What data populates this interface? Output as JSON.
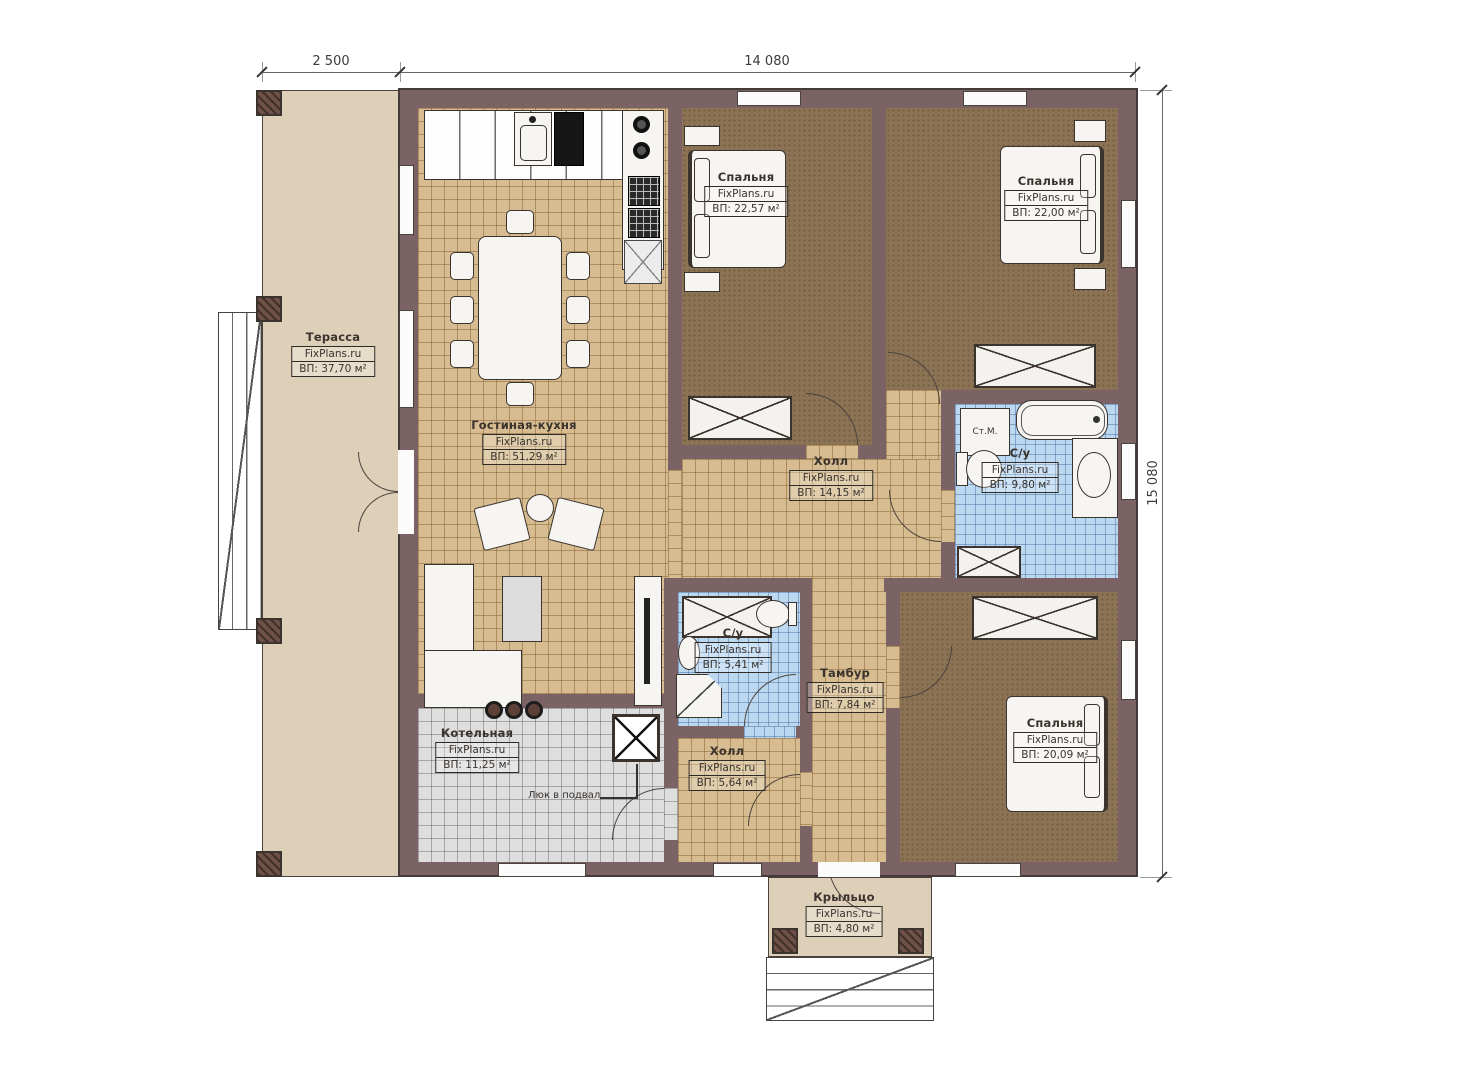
{
  "dimensions": {
    "terrace_width": "2 500",
    "house_width": "14 080",
    "house_height": "15 080"
  },
  "watermark": "FixPlans.ru",
  "rooms": {
    "terrace": {
      "name": "Терасса",
      "area": "ВП: 37,70 м²"
    },
    "living": {
      "name": "Гостиная-кухня",
      "area": "ВП: 51,29 м²"
    },
    "bedroom_top_left": {
      "name": "Спальня",
      "area": "ВП: 22,57 м²"
    },
    "bedroom_top_right": {
      "name": "Спальня",
      "area": "ВП: 22,00 м²"
    },
    "hall_main": {
      "name": "Холл",
      "area": "ВП: 14,15 м²"
    },
    "bathroom_main": {
      "name": "С/у",
      "area": "ВП: 9,80 м²"
    },
    "bathroom_small": {
      "name": "С/у",
      "area": "ВП: 5,41 м²"
    },
    "vestibule": {
      "name": "Тамбур",
      "area": "ВП: 7,84 м²"
    },
    "hall_small": {
      "name": "Холл",
      "area": "ВП: 5,64 м²"
    },
    "boiler": {
      "name": "Котельная",
      "area": "ВП: 11,25 м²"
    },
    "bedroom_bottom": {
      "name": "Спальня",
      "area": "ВП: 20,09 м²"
    },
    "porch": {
      "name": "Крыльцо",
      "area": "ВП: 4,80 м²"
    }
  },
  "annotations": {
    "washing_machine": "Ст.М.",
    "basement_hatch": "Люк в подвал"
  },
  "colors": {
    "wall": "#7b6365",
    "floor_tile_tan": "#d6bc90",
    "floor_tile_blue": "#bcd8f1",
    "floor_tile_gray": "#dedede",
    "floor_wood_brown": "#8d7355",
    "outdoor_deck": "#ded0b8",
    "line": "#3a332e"
  }
}
